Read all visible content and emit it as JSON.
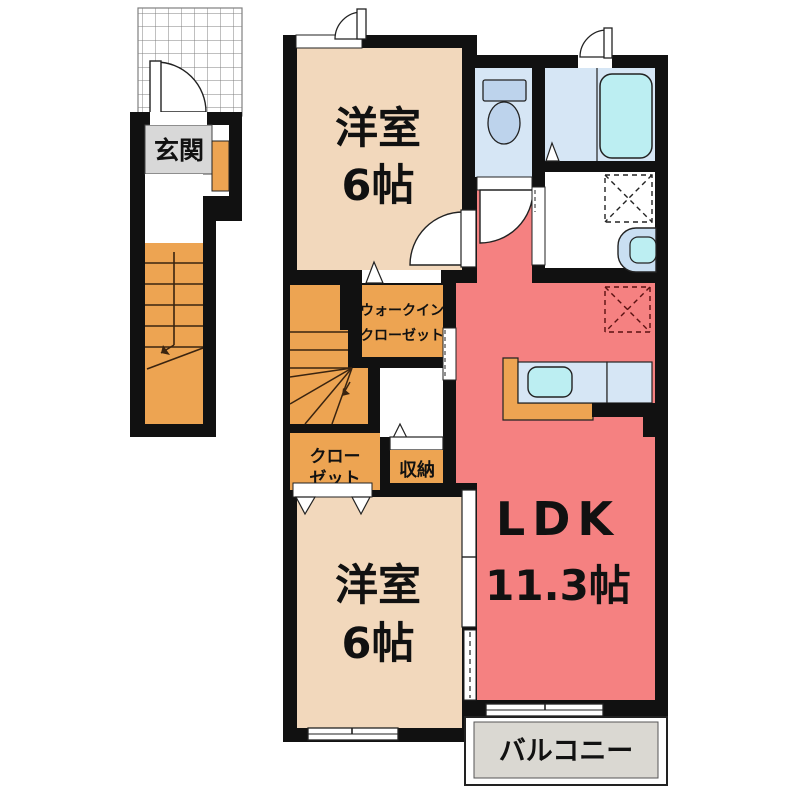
{
  "title": "2LDK apartment floor plan",
  "colors": {
    "wall": "#111111",
    "bedroom_peach": "#F2D8BC",
    "ldk_red": "#F58181",
    "orange": "#EDA452",
    "room_light_blue": "#D6E6F5",
    "water_cyan": "#BCEEF2",
    "fixture_blue": "#BDD3EC",
    "genkan_gray": "#D8D8D8",
    "balcony_gray": "#DAD8D2",
    "grid_line": "#808080"
  },
  "rooms": {
    "genkan": {
      "label": "玄関"
    },
    "bedroom_top": {
      "label": "洋室",
      "size": "6帖"
    },
    "bedroom_bottom": {
      "label": "洋室",
      "size": "6帖"
    },
    "ldk": {
      "label": "LDK",
      "size": "11.3帖"
    },
    "wic": {
      "label_line1": "ウォークイン",
      "label_line2": "クローゼット"
    },
    "closet": {
      "label_line1": "クロー",
      "label_line2": "ゼット"
    },
    "storage": {
      "label": "収納"
    },
    "balcony": {
      "label": "バルコニー"
    }
  }
}
